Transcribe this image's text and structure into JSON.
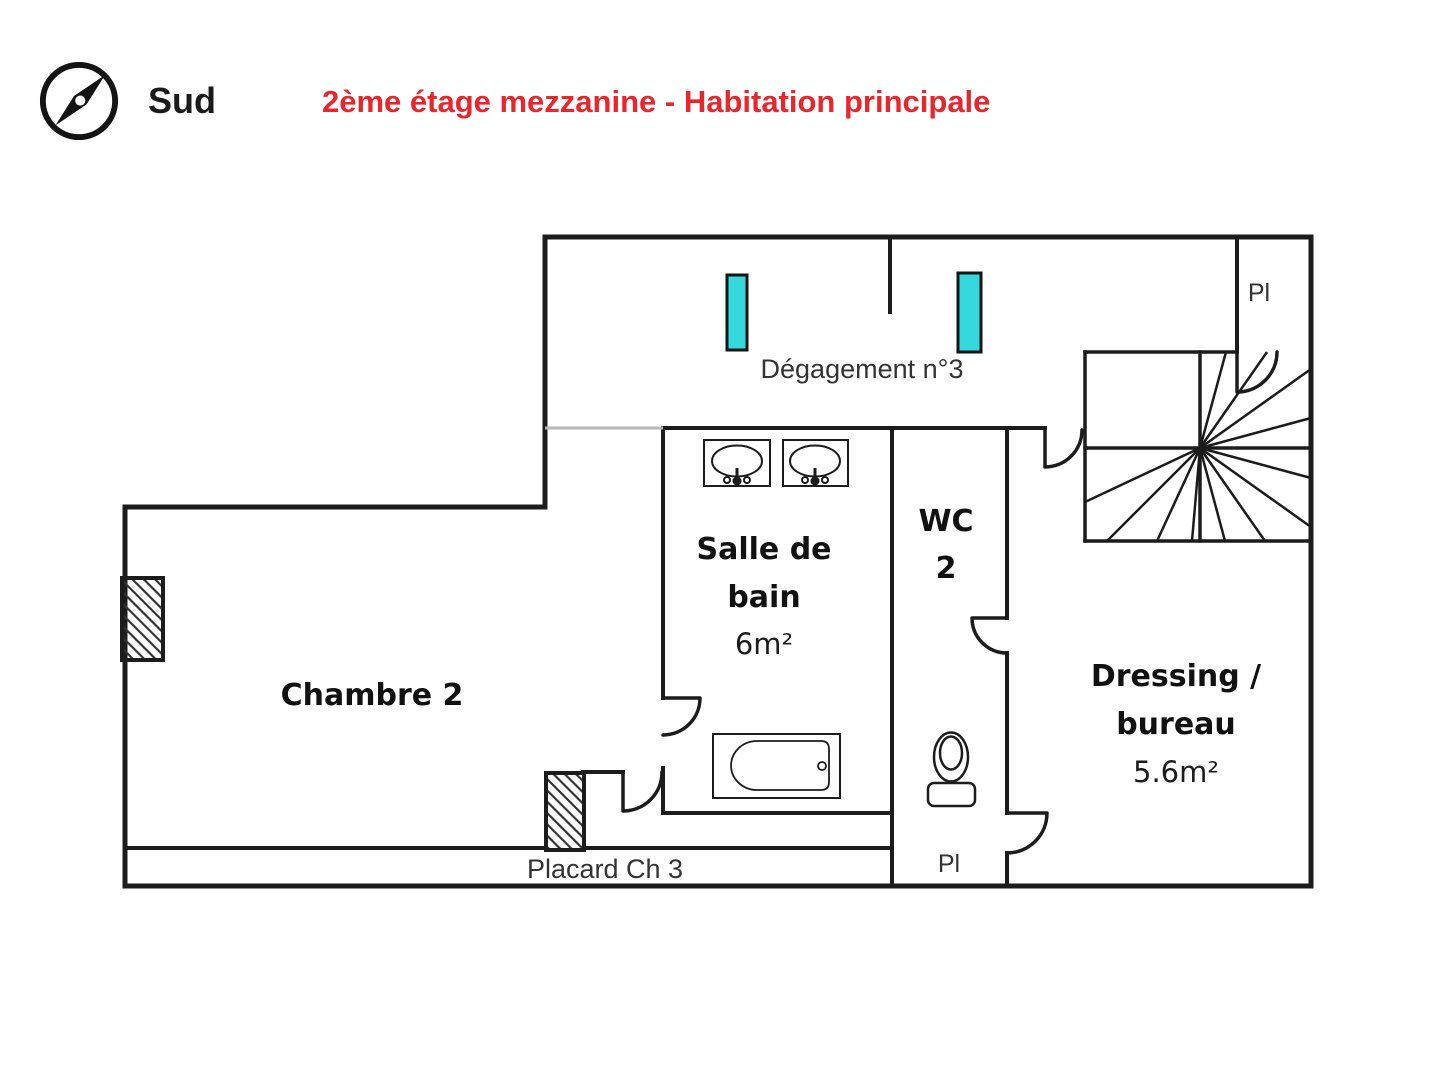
{
  "header": {
    "compass_label": "Sud",
    "title": "2ème étage mezzanine - Habitation principale"
  },
  "colors": {
    "title_red": "#e8262c",
    "wall_black": "#1c1c1c",
    "skylight_cyan": "#35d9dd",
    "hatch_gray": "#333333"
  },
  "rooms": {
    "degagement": {
      "label": "Dégagement n°3"
    },
    "pl_top": {
      "label": "Pl"
    },
    "salle_de_bain": {
      "line1": "Salle de",
      "line2": "bain",
      "area": "6m²"
    },
    "wc": {
      "line1": "WC",
      "line2": "2"
    },
    "chambre": {
      "label": "Chambre 2"
    },
    "dressing": {
      "line1": "Dressing /",
      "line2": "bureau",
      "area": "5.6m²"
    },
    "placard": {
      "label": "Placard Ch 3"
    },
    "pl_bottom": {
      "label": "Pl"
    }
  }
}
